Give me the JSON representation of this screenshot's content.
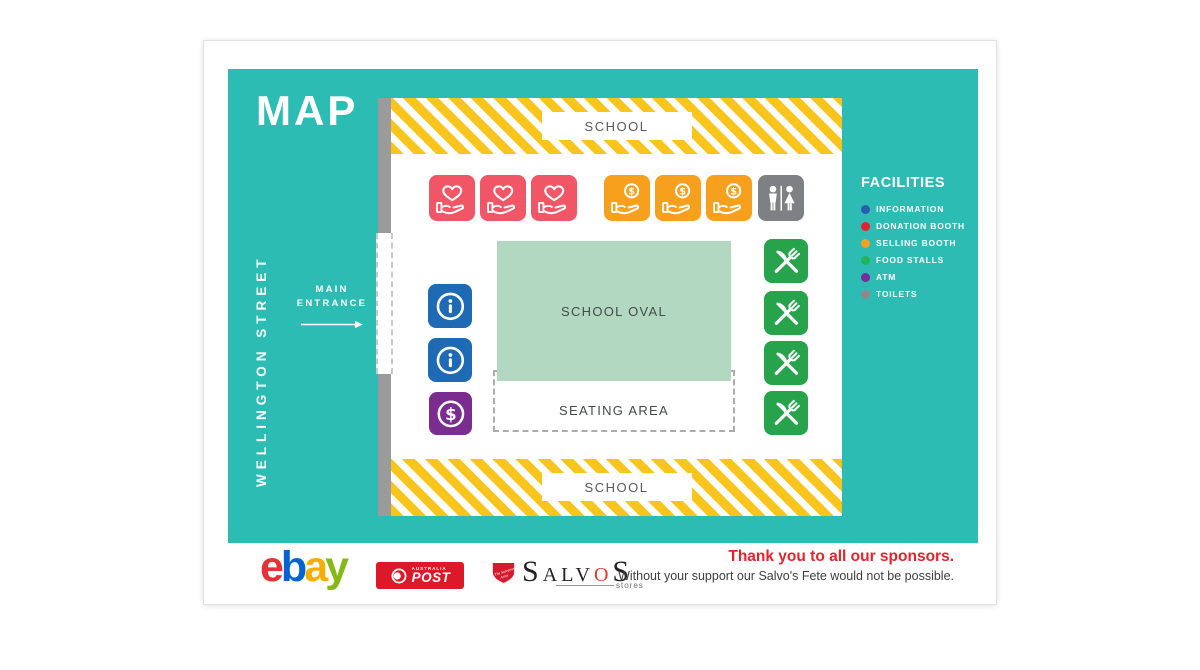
{
  "header": {
    "title": "MAP"
  },
  "street": {
    "label": "WELLINGTON STREET",
    "entrance_line1": "MAIN",
    "entrance_line2": "ENTRANCE"
  },
  "map": {
    "school_top_label": "SCHOOL",
    "school_bottom_label": "SCHOOL",
    "oval_label": "SCHOOL OVAL",
    "seating_label": "SEATING AREA",
    "icon_counts": {
      "donation_booth": 3,
      "selling_booth": 3,
      "toilets": 1,
      "information": 2,
      "atm": 1,
      "food_stalls": 4
    }
  },
  "facilities": {
    "title": "FACILITIES",
    "items": [
      {
        "label": "INFORMATION",
        "color": "#2B5CAD"
      },
      {
        "label": "DONATION BOOTH",
        "color": "#E91D2C"
      },
      {
        "label": "SELLING BOOTH",
        "color": "#F7A11F"
      },
      {
        "label": "FOOD STALLS",
        "color": "#23B45B"
      },
      {
        "label": "ATM",
        "color": "#7C2B9C"
      },
      {
        "label": "TOILETS",
        "color": "#8B8B8B"
      }
    ]
  },
  "sponsors": {
    "thanks_title": "Thank you to all our sponsors.",
    "thanks_subtitle": "Without your support our Salvo's Fete would not be possible.",
    "ebay": {
      "letters": [
        "e",
        "b",
        "a",
        "y"
      ],
      "colors": [
        "#E53238",
        "#0064D2",
        "#F5AF02",
        "#86B817"
      ]
    },
    "auspost": {
      "country": "AUSTRALIA",
      "name": "POST",
      "bg": "#DC1928"
    },
    "salvos": {
      "l0": "S",
      "l1": "ALV",
      "l2": "O",
      "l3": "S",
      "sub": "stores"
    }
  },
  "colors": {
    "teal": "#2CBCB4",
    "stripe_yellow": "#F9C51D",
    "oval_green": "#B2D8C1",
    "donation_tile": "#F15666",
    "selling_tile": "#F7A01E",
    "info_tile": "#1E6AB4",
    "atm_tile": "#7A2C8F",
    "food_tile": "#27A44B",
    "toilets_tile": "#7F8083",
    "gray_bar": "#9B9B9B"
  }
}
